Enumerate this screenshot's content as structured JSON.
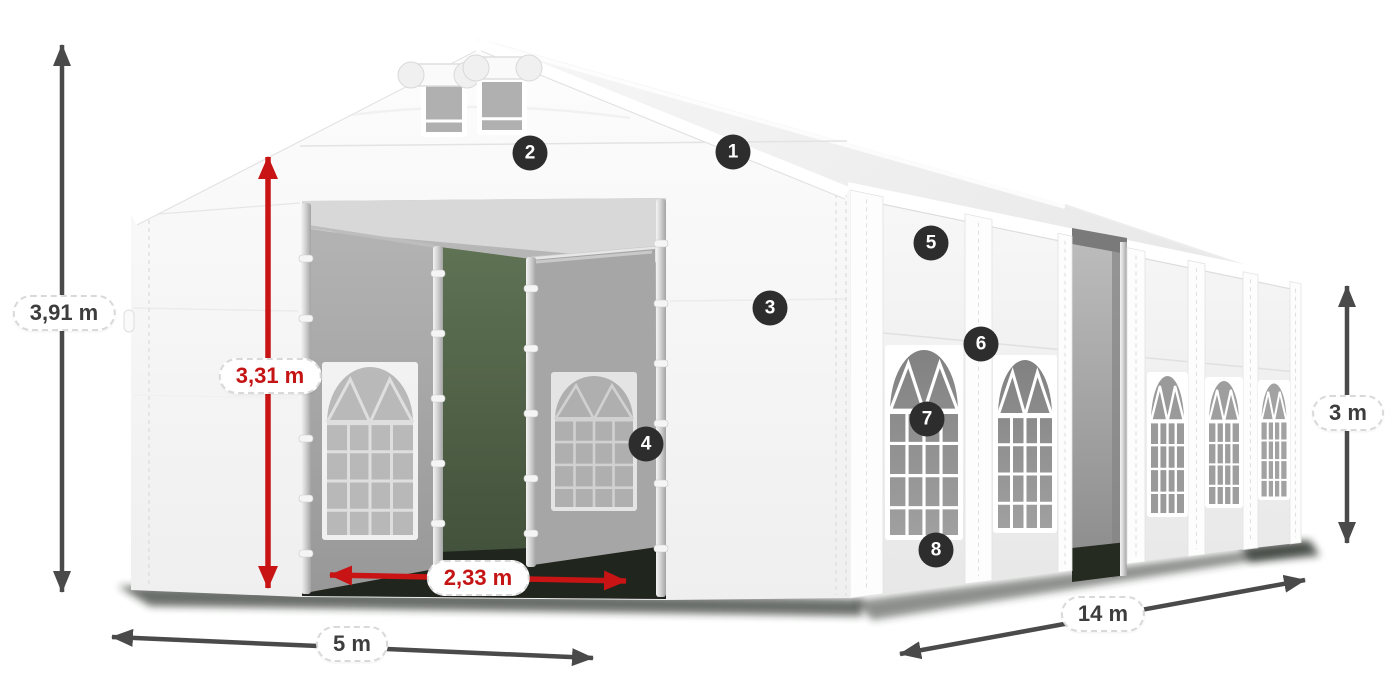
{
  "colors": {
    "marker_bg": "#2d2d2d",
    "marker_text": "#ffffff",
    "dim_dark": "#4a4a4a",
    "dim_red": "#c81414",
    "label_bg": "#ffffff",
    "label_border": "#d9d9d9",
    "label_text_dark": "#3d3d3d",
    "label_text_red": "#c41414"
  },
  "markers": [
    {
      "number": "1",
      "x": 733,
      "y": 152
    },
    {
      "number": "2",
      "x": 530,
      "y": 153
    },
    {
      "number": "3",
      "x": 770,
      "y": 308
    },
    {
      "number": "4",
      "x": 646,
      "y": 444
    },
    {
      "number": "5",
      "x": 931,
      "y": 243
    },
    {
      "number": "6",
      "x": 981,
      "y": 344
    },
    {
      "number": "7",
      "x": 927,
      "y": 419
    },
    {
      "number": "8",
      "x": 936,
      "y": 550
    }
  ],
  "dimensions": [
    {
      "id": "total-height",
      "label": "3,91 m",
      "style": "dark",
      "x1": 62,
      "y1": 45,
      "x2": 62,
      "y2": 592,
      "label_x": 64,
      "label_y": 313
    },
    {
      "id": "entrance-height",
      "label": "3,31 m",
      "style": "red",
      "x1": 268,
      "y1": 157,
      "x2": 268,
      "y2": 588,
      "label_x": 270,
      "label_y": 376
    },
    {
      "id": "entrance-width",
      "label": "2,33 m",
      "style": "red",
      "x1": 330,
      "y1": 575,
      "x2": 626,
      "y2": 581,
      "label_x": 478,
      "label_y": 578
    },
    {
      "id": "tent-width",
      "label": "5 m",
      "style": "dark",
      "x1": 112,
      "y1": 637,
      "x2": 593,
      "y2": 658,
      "label_x": 352,
      "label_y": 644
    },
    {
      "id": "tent-length",
      "label": "14 m",
      "style": "dark",
      "x1": 900,
      "y1": 654,
      "x2": 1305,
      "y2": 580,
      "label_x": 1103,
      "label_y": 614
    },
    {
      "id": "side-wall-height",
      "label": "3 m",
      "style": "dark",
      "x1": 1347,
      "y1": 286,
      "x2": 1347,
      "y2": 543,
      "label_x": 1348,
      "label_y": 413
    }
  ]
}
